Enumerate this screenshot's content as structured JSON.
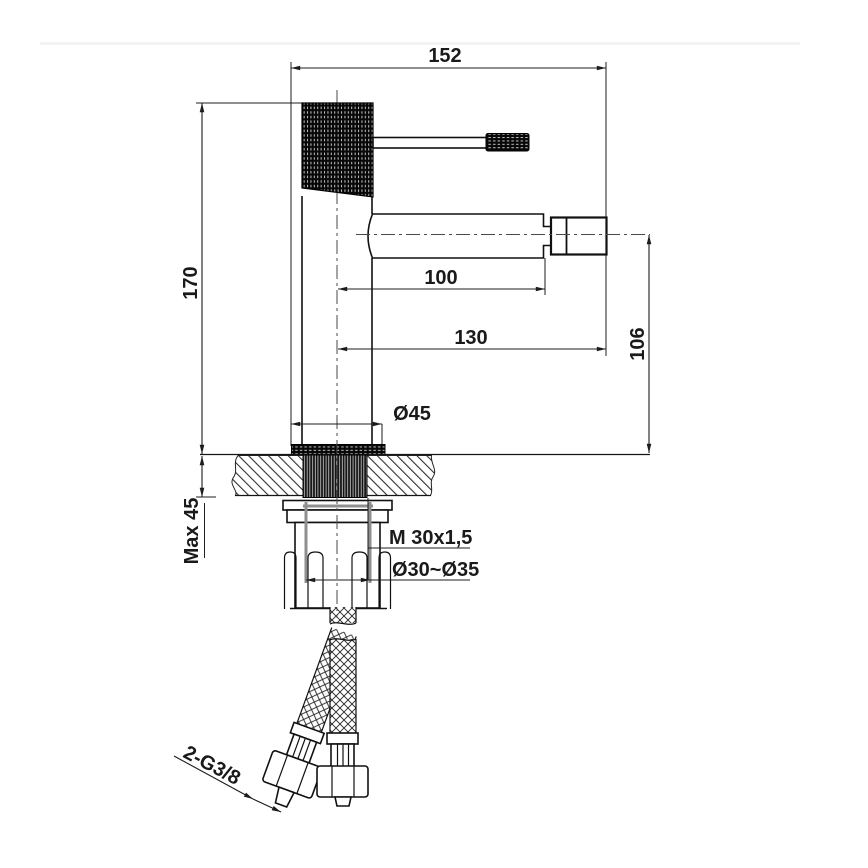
{
  "drawing": {
    "title": "bidet-mixer-technical-drawing",
    "dimensions": {
      "overall_width": "152",
      "overall_height": "170",
      "spout_reach": "100",
      "spout_total_reach": "130",
      "spout_height": "106",
      "base_diameter": "Ø45",
      "max_mounting_thickness": "Max 45",
      "mounting_thread": "M 30x1,5",
      "hole_diameter": "Ø30~Ø35",
      "supply_connection": "2-G3/8"
    },
    "colors": {
      "line": "#1c1c1c",
      "hidden_detail_gray": "#8f8f8f",
      "background": "#ffffff"
    }
  }
}
